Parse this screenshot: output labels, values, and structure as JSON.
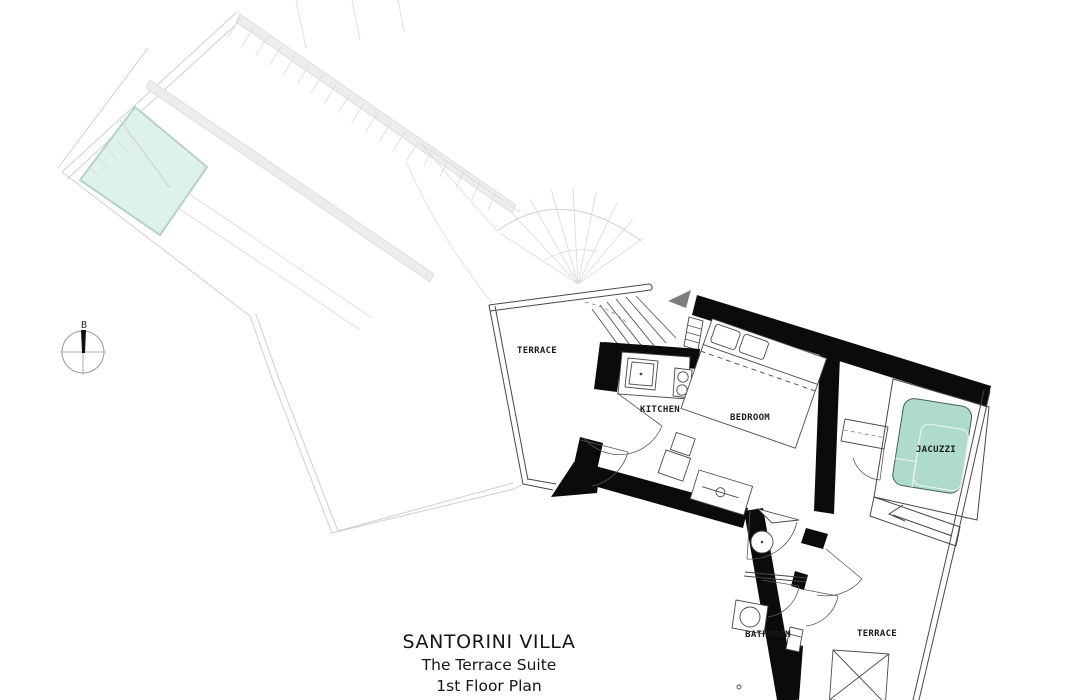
{
  "title": {
    "line1": "SANTORINI VILLA",
    "line2": "The Terrace Suite",
    "line3": "1st Floor Plan"
  },
  "rooms": {
    "terrace_left": "TERRACE",
    "kitchen": "KITCHEN",
    "bedroom": "BEDROOM",
    "jacuzzi": "JACUZZI",
    "bathroom": "BATHROOM",
    "terrace_right": "TERRACE"
  },
  "compass": {
    "label": "B"
  },
  "colors": {
    "wall": "#0b0b0b",
    "pool_fill": "#def1ea",
    "pool_stroke": "#b7d2c9",
    "jacuzzi_fill": "#aedbcc",
    "jacuzzi_stroke": "#4d5e57",
    "arrow": "#7d7d7d"
  }
}
